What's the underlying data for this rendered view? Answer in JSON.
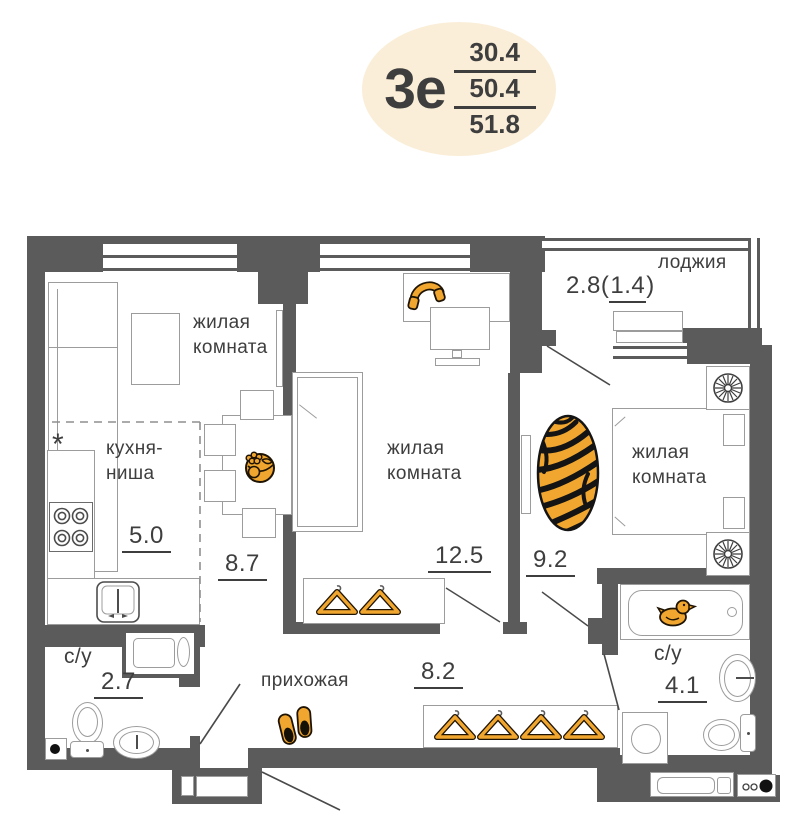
{
  "badge": {
    "label": "3е",
    "area_living": "30.4",
    "area_total": "50.4",
    "area_full": "51.8"
  },
  "rooms": {
    "living_room_1": {
      "name": "жилая\nкомната",
      "area": "8.7"
    },
    "kitchen_niche": {
      "name": "кухня-\nниша",
      "area": "5.0",
      "note": "*"
    },
    "living_room_2": {
      "name": "жилая\nкомната",
      "area": "12.5"
    },
    "living_room_3": {
      "name": "жилая\nкомната",
      "area": "9.2"
    },
    "loggia": {
      "name": "лоджия",
      "area_prefix": "2.8(",
      "area_underlined": "1.4",
      "area_suffix": ")"
    },
    "bathroom_1": {
      "name": "с/у",
      "area": "2.7"
    },
    "hallway": {
      "name": "прихожая",
      "area": "8.2"
    },
    "bathroom_2": {
      "name": "с/у",
      "area": "4.1"
    }
  },
  "colors": {
    "wall": "#5b5b5b",
    "fline": "#9c9c9c",
    "text": "#3e3e3e",
    "orange": "#f1a72f",
    "odark": "#2a1c06",
    "badge": "#faeed8"
  },
  "icons": {
    "fruit-bowl-icon": "orange fruit bowl on dining table",
    "headphones-icon": "orange headphones on desk",
    "tiger-rug-icon": "oval tiger-stripe rug",
    "rubber-duck-icon": "orange rubber duck in bathtub",
    "slippers-icon": "pair of orange slippers",
    "hanger-icon": "orange clothes hanger",
    "fan-icon": "ventilation fan symbol",
    "stove-icon": "four-burner stove",
    "electric-panel-icon": "meter panel dots"
  }
}
